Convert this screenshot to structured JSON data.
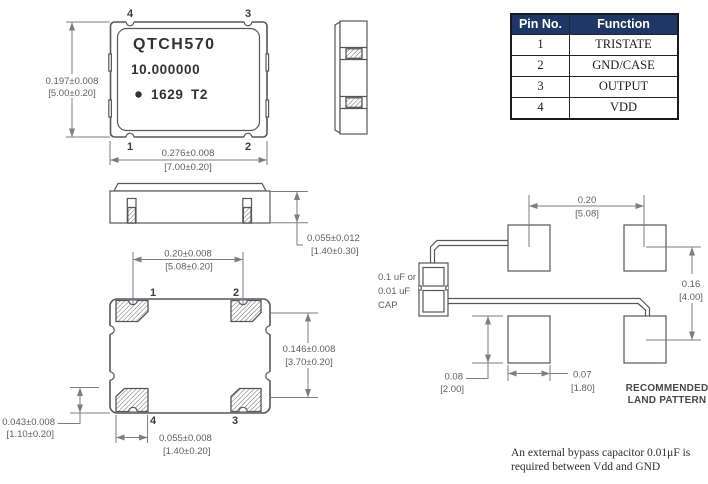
{
  "pin_table": {
    "headers": [
      "Pin No.",
      "Function"
    ],
    "rows": [
      {
        "pin": "1",
        "function": "TRISTATE"
      },
      {
        "pin": "2",
        "function": "GND/CASE"
      },
      {
        "pin": "3",
        "function": "OUTPUT"
      },
      {
        "pin": "4",
        "function": "VDD"
      }
    ]
  },
  "top_view": {
    "marking": {
      "model": "QTCH570",
      "frequency": "10.000000",
      "date_code": "1629",
      "code": "T2"
    },
    "pins": {
      "top_left": "4",
      "top_right": "3",
      "bottom_left": "1",
      "bottom_right": "2"
    },
    "dim_height": {
      "inch": "0.197±0.008",
      "mm": "[5.00±0.20]"
    },
    "dim_width": {
      "inch": "0.276±0.008",
      "mm": "[7.00±0.20]"
    }
  },
  "side_view": {
    "dim_thickness": {
      "inch": "0.055±0.012",
      "mm": "[1.40±0.30]"
    }
  },
  "bottom_view": {
    "pins": {
      "top_left": "1",
      "top_right": "2",
      "bottom_left": "4",
      "bottom_right": "3"
    },
    "dim_pad_span": {
      "inch": "0.20±0.008",
      "mm": "[5.08±0.20]"
    },
    "dim_pad_vspan": {
      "inch": "0.146±0.008",
      "mm": "[3.70±0.20]"
    },
    "dim_pad_width": {
      "inch": "0.055±0.008",
      "mm": "[1.40±0.20]"
    },
    "dim_pad_height": {
      "inch": "0.043±0.008",
      "mm": "[1.10±0.20]"
    }
  },
  "land_pattern": {
    "title": {
      "line1": "RECOMMENDED",
      "line2": "LAND PATTERN"
    },
    "cap_label": {
      "line1": "0.1 uF or",
      "line2": "0.01 uF",
      "line3": "CAP"
    },
    "dim_span_x": {
      "inch": "0.20",
      "mm": "[5.08]"
    },
    "dim_span_y": {
      "inch": "0.16",
      "mm": "[4.00]"
    },
    "dim_pad_height": {
      "inch": "0.08",
      "mm": "[2.00]"
    },
    "dim_pad_width": {
      "inch": "0.07",
      "mm": "[1.80]"
    }
  },
  "note": {
    "line1": "An external bypass capacitor 0.01μF is",
    "line2": "required between Vdd and GND"
  }
}
